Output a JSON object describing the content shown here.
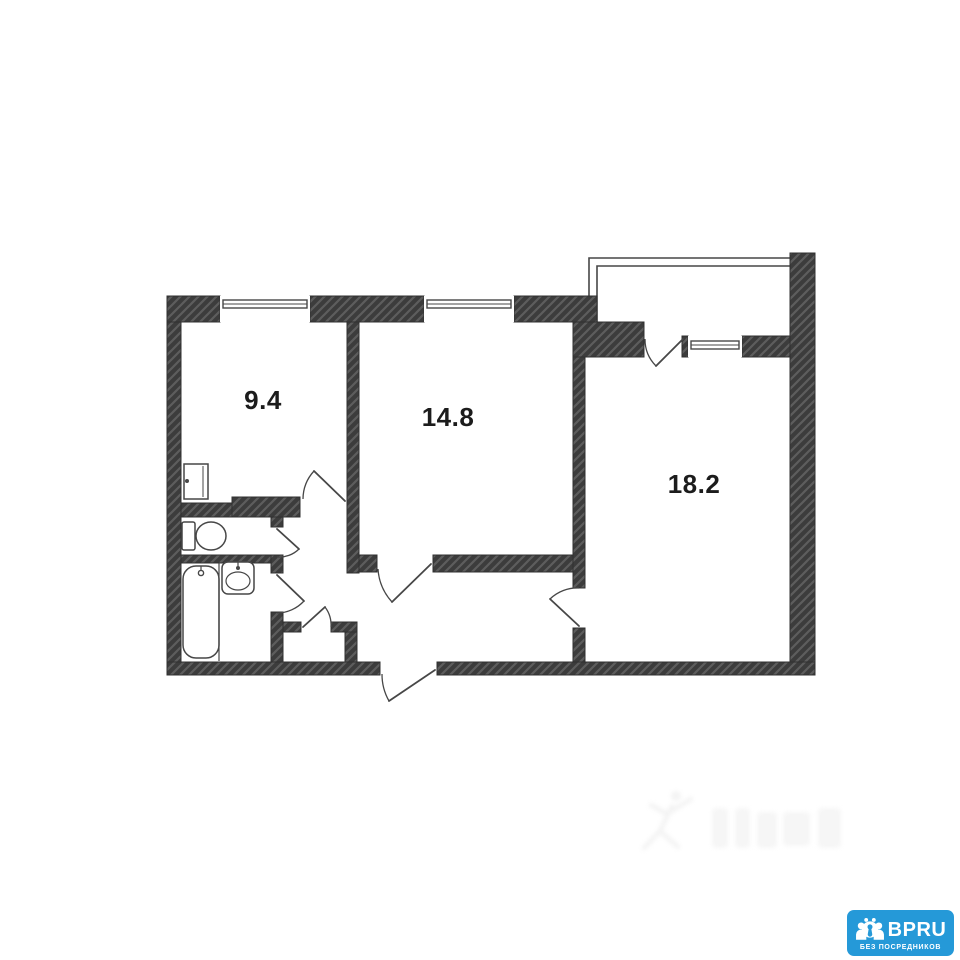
{
  "page": {
    "background": "#ffffff"
  },
  "floorplan": {
    "colors": {
      "wall_fill": "#3c3c3c",
      "wall_hatch": "#5d5d5d",
      "wall_edge": "#303030",
      "line": "#474747",
      "label": "#1c1c1c"
    },
    "rooms": [
      {
        "id": "room-9-4",
        "area_label": "9.4",
        "label_pos": {
          "x": 263,
          "y": 409
        }
      },
      {
        "id": "room-14-8",
        "area_label": "14.8",
        "label_pos": {
          "x": 448,
          "y": 426
        }
      },
      {
        "id": "room-18-2",
        "area_label": "18.2",
        "label_pos": {
          "x": 694,
          "y": 493
        }
      }
    ],
    "walls": [
      [
        167,
        296,
        14,
        379
      ],
      [
        167,
        296,
        53,
        26
      ],
      [
        310,
        296,
        114,
        26
      ],
      [
        514,
        296,
        83,
        26
      ],
      [
        573,
        322,
        71,
        35
      ],
      [
        682,
        336,
        6,
        21
      ],
      [
        742,
        336,
        48,
        21
      ],
      [
        790,
        253,
        25,
        422
      ],
      [
        167,
        662,
        213,
        13
      ],
      [
        437,
        662,
        378,
        13
      ],
      [
        347,
        322,
        12,
        251
      ],
      [
        573,
        357,
        12,
        231
      ],
      [
        573,
        628,
        12,
        34
      ],
      [
        359,
        555,
        18,
        17
      ],
      [
        433,
        555,
        140,
        17
      ],
      [
        181,
        503,
        51,
        14
      ],
      [
        232,
        497,
        68,
        20
      ],
      [
        271,
        517,
        12,
        10
      ],
      [
        181,
        555,
        94,
        8
      ],
      [
        271,
        555,
        12,
        18
      ],
      [
        271,
        612,
        12,
        50
      ],
      [
        283,
        622,
        18,
        10
      ],
      [
        331,
        622,
        26,
        10
      ],
      [
        345,
        632,
        12,
        30
      ]
    ],
    "windows": [
      {
        "name": "window-room-9",
        "x": 220,
        "y": 296,
        "w": 90,
        "h": 26,
        "frame_y": 300,
        "frame_h": 8
      },
      {
        "name": "window-room-14",
        "x": 424,
        "y": 296,
        "w": 90,
        "h": 26,
        "frame_y": 300,
        "frame_h": 8
      },
      {
        "name": "window-balcony",
        "x": 688,
        "y": 336,
        "w": 54,
        "h": 21,
        "frame_y": 341,
        "frame_h": 8
      }
    ],
    "balcony_lines": [
      "M589,322 L589,258 L790,258",
      "M597,322 L597,266 L790,266"
    ],
    "doors": [
      {
        "name": "balcony-door",
        "leaf": "M683,339 L656,366",
        "arc": "M645,339 A38,38 0 0 0 656,366"
      },
      {
        "name": "room-9-door",
        "leaf": "M345,501 L314,471",
        "arc": "M303,499 A42,42 0 0 1 314,471"
      },
      {
        "name": "wc-door",
        "leaf": "M277,529 L299,549",
        "arc": "M277,557 A28,28 0 0 0 299,549"
      },
      {
        "name": "bathroom-door",
        "leaf": "M277,575 L304,601",
        "arc": "M277,613 A37,37 0 0 0 304,601"
      },
      {
        "name": "closet-door",
        "leaf": "M303,627 L325,607",
        "arc": "M331,627 A30,30 0 0 0 325,607"
      },
      {
        "name": "room-14-door",
        "leaf": "M431,564 L392,602",
        "arc": "M378,569 A54,54 0 0 0 392,602"
      },
      {
        "name": "room-18-door",
        "leaf": "M579,626 L550,599",
        "arc": "M579,588 A39,39 0 0 0 550,599"
      },
      {
        "name": "entrance-door",
        "leaf": "M435,670 L389,701",
        "arc": "M382,674 A54,54 0 0 0 389,701"
      }
    ],
    "fixtures": [
      {
        "type": "wall-cabinet",
        "x": 184,
        "y": 464,
        "w": 24,
        "h": 35
      },
      {
        "type": "toilet",
        "tank": [
          182,
          522,
          13,
          28
        ],
        "bowl": [
          211,
          536,
          15,
          14
        ]
      },
      {
        "type": "bathtub",
        "x": 183,
        "y": 566,
        "w": 36,
        "h": 92,
        "r": 13,
        "faucet": [
          201,
          573
        ]
      },
      {
        "type": "sink",
        "x": 222,
        "y": 562,
        "w": 32,
        "h": 32,
        "basin": [
          238,
          581,
          12,
          9
        ],
        "faucet": [
          238,
          568
        ]
      },
      {
        "type": "divider-line",
        "x1": 219,
        "y1": 563,
        "x2": 219,
        "y2": 661
      }
    ]
  },
  "watermark": {
    "present": true,
    "style": "very-faint-illegible",
    "icon": "leaping-figure"
  },
  "badge": {
    "brand": "BPRU",
    "tagline": "БЕЗ ПОСРЕДНИКОВ",
    "bg_color": "#2599d8",
    "text_color": "#ffffff",
    "icon": "people-group-keyhole"
  }
}
